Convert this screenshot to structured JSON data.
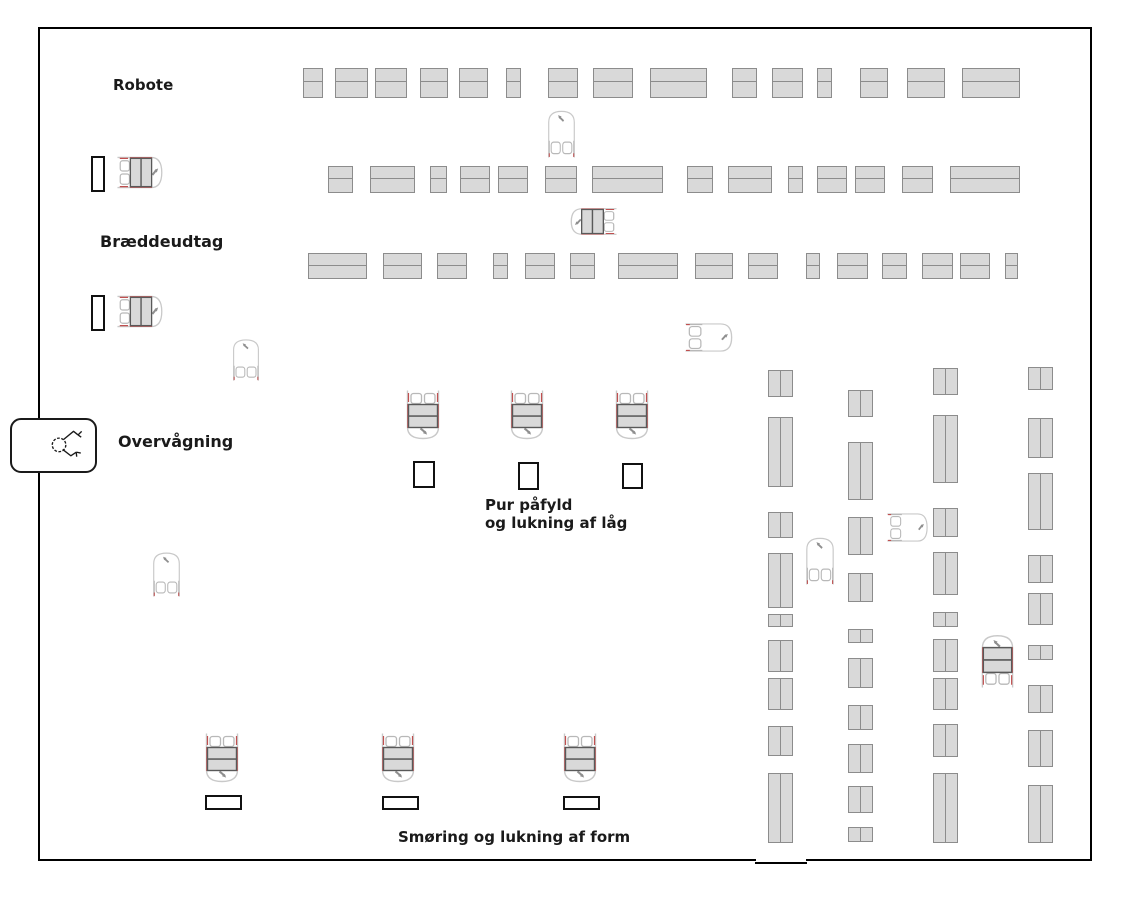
{
  "diagram": {
    "type": "factory-floor-plan",
    "labels": {
      "robote": "Robote",
      "braeddeudtag": "Bræddeudtag",
      "overvaagning": "Overvågning",
      "pur_line1": "Pur påfyld",
      "pur_line2": "og lukning af låg",
      "smoring": "Smøring og lukning af form"
    },
    "colors": {
      "wall": "#000000",
      "text": "#1a1a1a",
      "rack_fill": "#d9d9d9",
      "rack_border": "#8c8c8c",
      "agv_outline": "#c9c9c9",
      "agv_wheel": "#b8b8b8",
      "agv_accent_red": "#c05050",
      "agv_arrow": "#8f8f8f",
      "load_fill": "#d9d9d9",
      "load_border": "#595959",
      "slot_border": "#111111"
    },
    "floor": {
      "x": 38,
      "y": 27,
      "w": 1054,
      "h": 834
    },
    "racks_horizontal": [
      {
        "y": 68,
        "h": 30,
        "bars": [
          [
            303,
            20
          ],
          [
            335,
            33
          ],
          [
            375,
            32
          ],
          [
            420,
            28
          ],
          [
            459,
            29
          ],
          [
            506,
            15
          ],
          [
            548,
            30
          ],
          [
            593,
            40
          ],
          [
            650,
            57
          ],
          [
            732,
            25
          ],
          [
            772,
            31
          ],
          [
            817,
            15
          ],
          [
            860,
            28
          ],
          [
            907,
            38
          ],
          [
            962,
            58
          ]
        ]
      },
      {
        "y": 166,
        "h": 27,
        "bars": [
          [
            328,
            25
          ],
          [
            370,
            45
          ],
          [
            430,
            17
          ],
          [
            460,
            30
          ],
          [
            498,
            30
          ],
          [
            545,
            32
          ],
          [
            592,
            71
          ],
          [
            687,
            26
          ],
          [
            728,
            44
          ],
          [
            788,
            15
          ],
          [
            817,
            30
          ],
          [
            855,
            30
          ],
          [
            902,
            31
          ],
          [
            950,
            70
          ]
        ]
      },
      {
        "y": 253,
        "h": 26,
        "bars": [
          [
            308,
            59
          ],
          [
            383,
            39
          ],
          [
            437,
            30
          ],
          [
            493,
            15
          ],
          [
            525,
            30
          ],
          [
            570,
            25
          ],
          [
            618,
            60
          ],
          [
            695,
            38
          ],
          [
            748,
            30
          ],
          [
            806,
            14
          ],
          [
            837,
            31
          ],
          [
            882,
            25
          ],
          [
            922,
            31
          ],
          [
            960,
            30
          ],
          [
            1005,
            13
          ]
        ]
      }
    ],
    "racks_vertical": [
      {
        "x": 768,
        "w": 25,
        "bars": [
          [
            370,
            27
          ],
          [
            417,
            70
          ],
          [
            512,
            26
          ],
          [
            553,
            55
          ],
          [
            614,
            13
          ],
          [
            640,
            32
          ],
          [
            678,
            32
          ],
          [
            726,
            30
          ],
          [
            773,
            70
          ]
        ]
      },
      {
        "x": 848,
        "w": 25,
        "bars": [
          [
            390,
            27
          ],
          [
            442,
            58
          ],
          [
            517,
            38
          ],
          [
            573,
            29
          ],
          [
            629,
            14
          ],
          [
            658,
            30
          ],
          [
            705,
            25
          ],
          [
            744,
            29
          ],
          [
            786,
            27
          ],
          [
            827,
            15
          ]
        ]
      },
      {
        "x": 933,
        "w": 25,
        "bars": [
          [
            368,
            27
          ],
          [
            415,
            68
          ],
          [
            508,
            29
          ],
          [
            552,
            43
          ],
          [
            612,
            15
          ],
          [
            639,
            33
          ],
          [
            678,
            32
          ],
          [
            724,
            33
          ],
          [
            773,
            70
          ]
        ]
      },
      {
        "x": 1028,
        "w": 25,
        "bars": [
          [
            367,
            23
          ],
          [
            418,
            40
          ],
          [
            473,
            57
          ],
          [
            555,
            28
          ],
          [
            593,
            32
          ],
          [
            645,
            15
          ],
          [
            685,
            28
          ],
          [
            730,
            37
          ],
          [
            785,
            58
          ]
        ]
      }
    ],
    "slots": [
      {
        "x": 91,
        "y": 156,
        "w": 14,
        "h": 36,
        "name": "buffer-slot-robote"
      },
      {
        "x": 91,
        "y": 295,
        "w": 14,
        "h": 36,
        "name": "buffer-slot-braeddeudtag"
      },
      {
        "x": 413,
        "y": 461,
        "w": 22,
        "h": 27,
        "name": "pur-fill-station-slot"
      },
      {
        "x": 518,
        "y": 462,
        "w": 21,
        "h": 28,
        "name": "pur-fill-station-slot"
      },
      {
        "x": 622,
        "y": 463,
        "w": 21,
        "h": 26,
        "name": "pur-fill-station-slot"
      },
      {
        "x": 205,
        "y": 795,
        "w": 37,
        "h": 15,
        "name": "form-station-slot"
      },
      {
        "x": 382,
        "y": 796,
        "w": 37,
        "h": 14,
        "name": "form-station-slot"
      },
      {
        "x": 563,
        "y": 796,
        "w": 37,
        "h": 14,
        "name": "form-station-slot"
      }
    ],
    "agvs": [
      {
        "x": 117,
        "y": 153,
        "w": 48,
        "h": 39,
        "dir": "right",
        "loaded": true
      },
      {
        "x": 117,
        "y": 292,
        "w": 48,
        "h": 39,
        "dir": "right",
        "loaded": true
      },
      {
        "x": 545,
        "y": 108,
        "w": 33,
        "h": 50,
        "dir": "up",
        "loaded": false
      },
      {
        "x": 568,
        "y": 205,
        "w": 49,
        "h": 33,
        "dir": "left",
        "loaded": true
      },
      {
        "x": 230,
        "y": 337,
        "w": 32,
        "h": 44,
        "dir": "up",
        "loaded": false
      },
      {
        "x": 685,
        "y": 320,
        "w": 50,
        "h": 35,
        "dir": "right",
        "loaded": false
      },
      {
        "x": 403,
        "y": 390,
        "w": 40,
        "h": 52,
        "dir": "down",
        "loaded": true
      },
      {
        "x": 507,
        "y": 390,
        "w": 40,
        "h": 52,
        "dir": "down",
        "loaded": true
      },
      {
        "x": 612,
        "y": 390,
        "w": 40,
        "h": 52,
        "dir": "down",
        "loaded": true
      },
      {
        "x": 150,
        "y": 550,
        "w": 33,
        "h": 47,
        "dir": "up",
        "loaded": false
      },
      {
        "x": 803,
        "y": 535,
        "w": 34,
        "h": 50,
        "dir": "up",
        "loaded": false
      },
      {
        "x": 887,
        "y": 510,
        "w": 43,
        "h": 35,
        "dir": "right",
        "loaded": false
      },
      {
        "x": 978,
        "y": 632,
        "w": 39,
        "h": 56,
        "dir": "up",
        "loaded": true
      },
      {
        "x": 202,
        "y": 733,
        "w": 40,
        "h": 52,
        "dir": "down",
        "loaded": true
      },
      {
        "x": 378,
        "y": 733,
        "w": 40,
        "h": 52,
        "dir": "down",
        "loaded": true
      },
      {
        "x": 560,
        "y": 733,
        "w": 40,
        "h": 52,
        "dir": "down",
        "loaded": true
      }
    ],
    "monitor_station": {
      "x": 10,
      "y": 418,
      "w": 87,
      "h": 55,
      "icon": "surveillance-camera-sketch-icon"
    }
  }
}
